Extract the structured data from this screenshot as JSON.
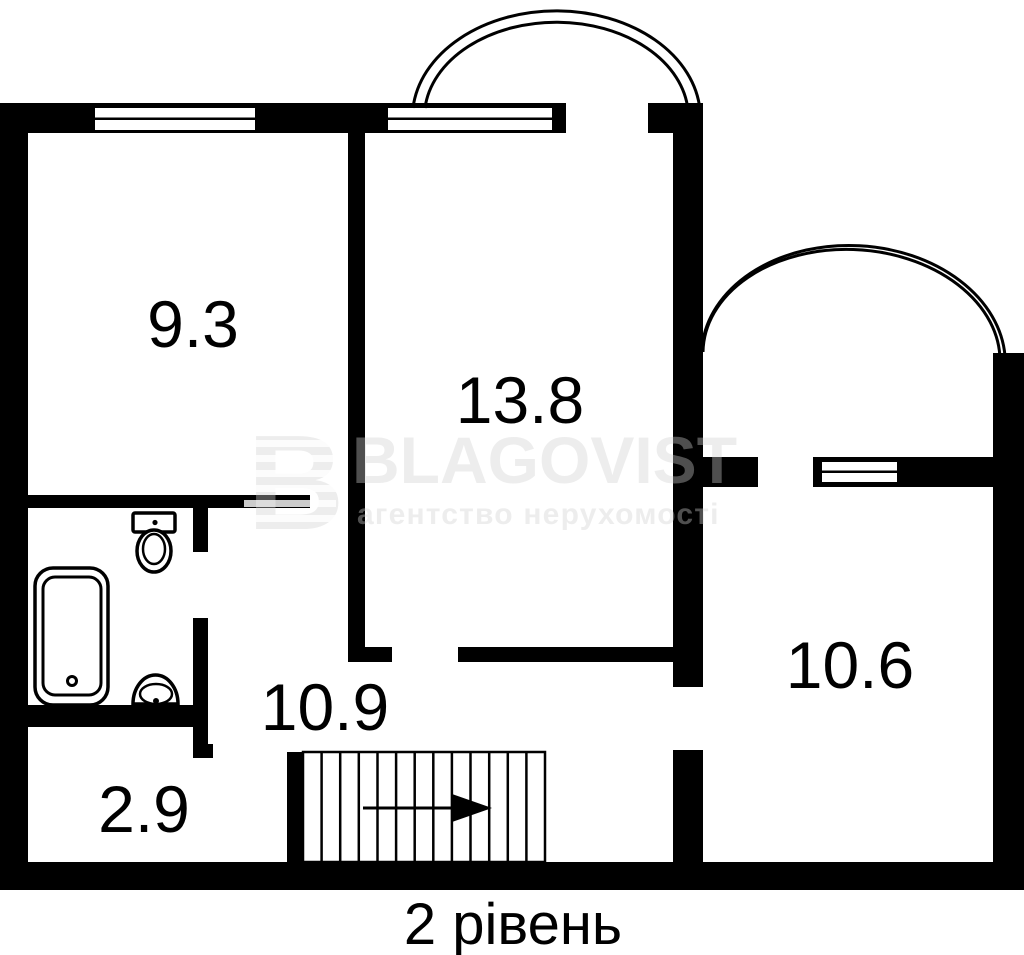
{
  "plan": {
    "rooms": [
      {
        "name": "room-9-3",
        "area": "9.3"
      },
      {
        "name": "room-13-8",
        "area": "13.8"
      },
      {
        "name": "room-10-6",
        "area": "10.6"
      },
      {
        "name": "hall-10-9",
        "area": "10.9"
      },
      {
        "name": "room-2-9",
        "area": "2.9"
      }
    ],
    "caption": "2 рівень"
  },
  "watermark": {
    "logo_letter": "B",
    "brand": "BLAGOVIST",
    "tagline": "агентство нерухомості"
  },
  "icons": {
    "bathtub": "bathtub-icon",
    "toilet": "toilet-icon",
    "sink": "sink-icon",
    "stairs_arrow": "stairs-direction-arrow-icon"
  },
  "colors": {
    "wall": "#000000",
    "background": "#ffffff",
    "watermark": "#ededed"
  }
}
